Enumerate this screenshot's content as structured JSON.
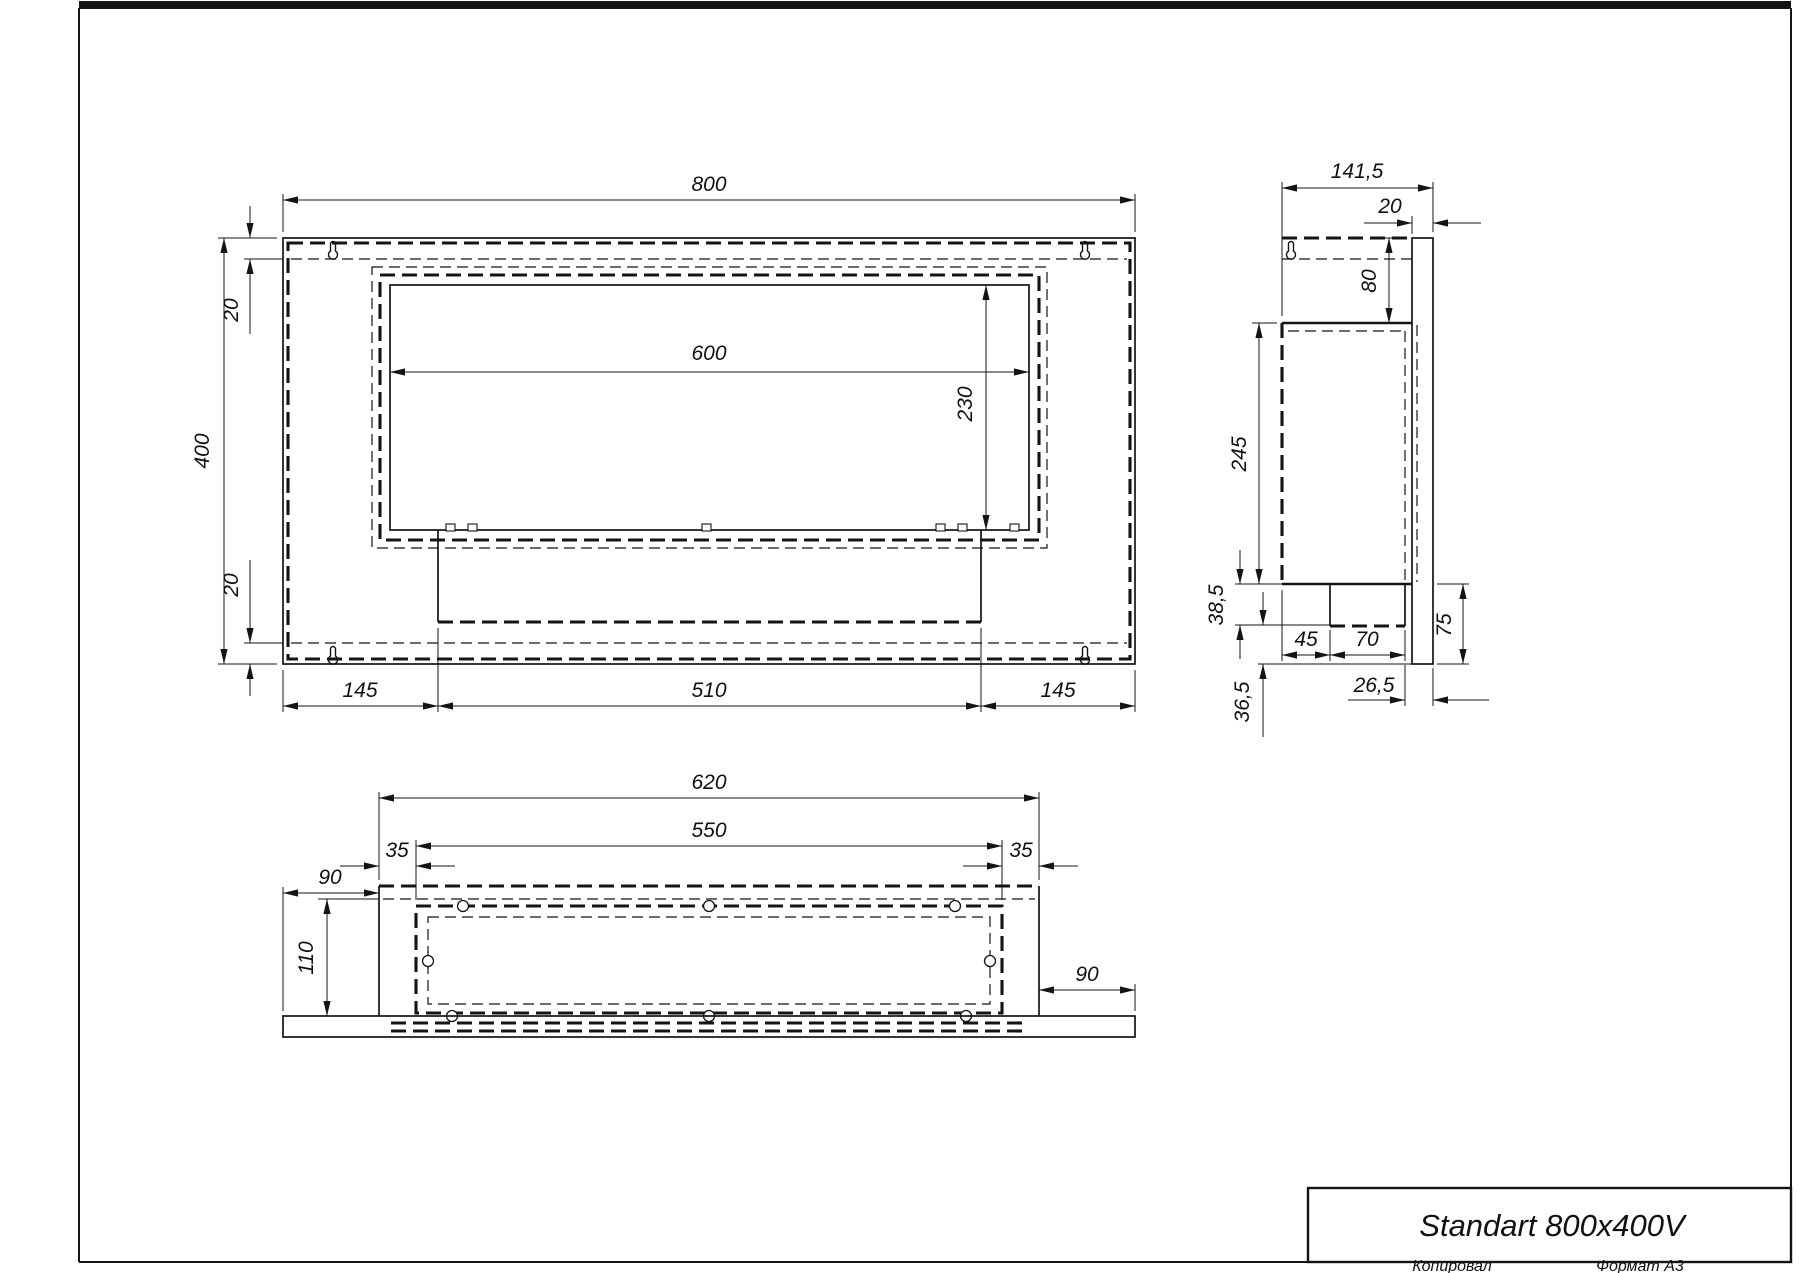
{
  "title_block": {
    "product_title": "Standart 800x400V",
    "copied_by_label": "Копировал",
    "format_label": "Формат А3"
  },
  "dims": {
    "front": {
      "width": "800",
      "height": "400",
      "top_inset": "20",
      "bottom_inset": "20",
      "opening_width": "600",
      "opening_height": "230",
      "left_margin": "145",
      "burner_width": "510",
      "right_margin": "145"
    },
    "side": {
      "depth": "141,5",
      "panel_thickness": "20",
      "panel_top_to_box": "80",
      "box_height": "245",
      "box_to_tray_bottom": "38,5",
      "tray_to_panel_bottom": "36,5",
      "tray_offset": "45",
      "tray_width": "70",
      "tray_to_back": "26,5",
      "below_box_height": "75"
    },
    "bottom": {
      "box_width": "620",
      "mount_span": "550",
      "left_inset": "35",
      "right_inset": "35",
      "left_overhang": "90",
      "right_overhang": "90",
      "inner_depth": "110"
    }
  }
}
